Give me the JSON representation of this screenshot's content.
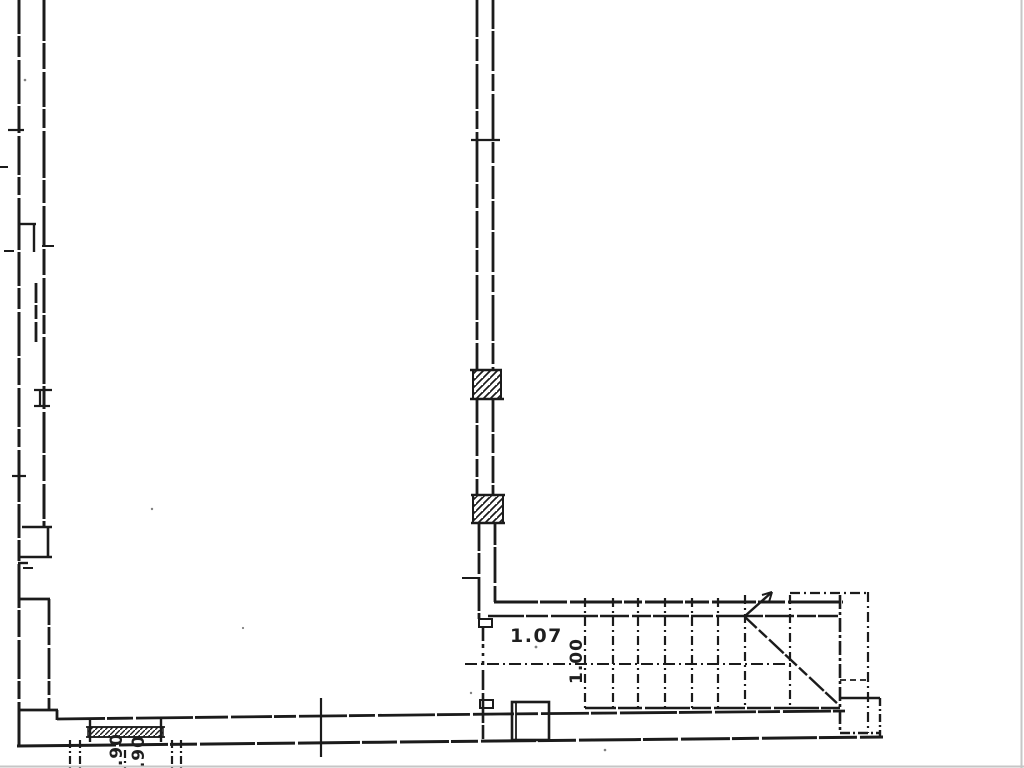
{
  "document": {
    "labels": {
      "room_width": "1.07",
      "stair_width": "1.00",
      "dim_bottom_left": "0.90",
      "dim_bottom_right": "0.90"
    },
    "colors": {
      "ink": "#1b1b1b",
      "paper": "#ffffff",
      "scan_edge": "#c6c6c6"
    }
  }
}
